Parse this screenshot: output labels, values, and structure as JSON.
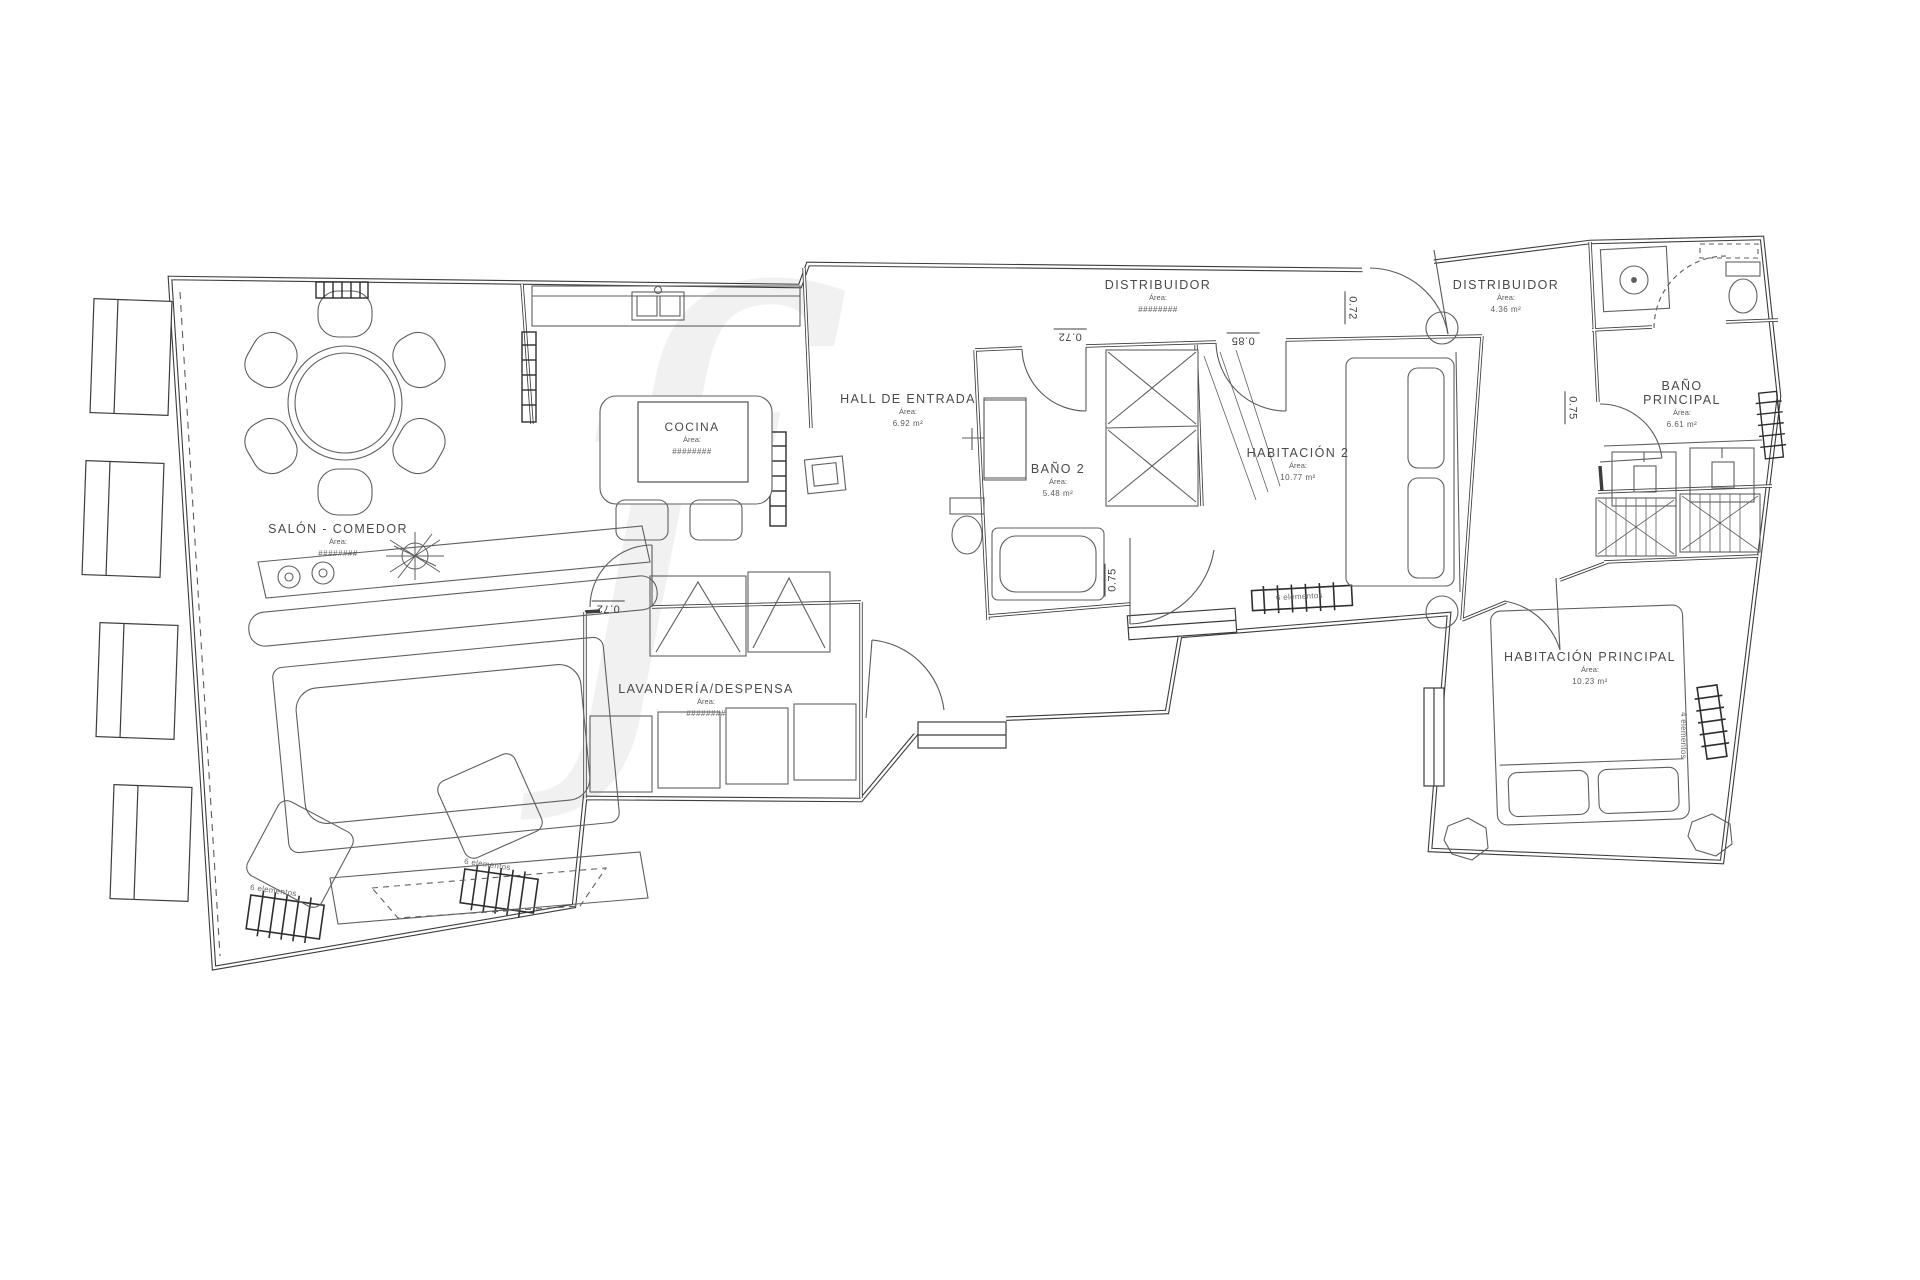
{
  "plan": {
    "watermark": "f",
    "rooms": [
      {
        "name": "SALÓN - COMEDOR",
        "area_label": "Área:",
        "area": "########"
      },
      {
        "name": "COCINA",
        "area_label": "Área:",
        "area": "########"
      },
      {
        "name": "LAVANDERÍA/DESPENSA",
        "area_label": "Área:",
        "area": "########"
      },
      {
        "name": "HALL DE ENTRADA",
        "area_label": "Área:",
        "area": "6.92 m²"
      },
      {
        "name": "BAÑO 2",
        "area_label": "Área:",
        "area": "5.48 m²"
      },
      {
        "name": "DISTRIBUIDOR",
        "area_label": "Área:",
        "area": "########"
      },
      {
        "name": "DISTRIBUIDOR",
        "area_label": "Área:",
        "area": "4.36 m²"
      },
      {
        "name": "HABITACIÓN 2",
        "area_label": "Área:",
        "area": "10.77 m²"
      },
      {
        "name": "BAÑO PRINCIPAL",
        "area_label": "Área:",
        "area": "6.61 m²"
      },
      {
        "name": "HABITACIÓN PRINCIPAL",
        "area_label": "Área:",
        "area": "10.23 m²"
      }
    ],
    "dimensions": [
      "0.72",
      "0.85",
      "0.72",
      "0.75",
      "0.75",
      "0.72"
    ],
    "radiator_labels": [
      "6 elementos",
      "6 elementos",
      "6 elementos",
      "4 elementos"
    ],
    "colors": {
      "wall": "#3c3c3c",
      "furniture": "#5f5f5f",
      "background": "#ffffff"
    }
  }
}
